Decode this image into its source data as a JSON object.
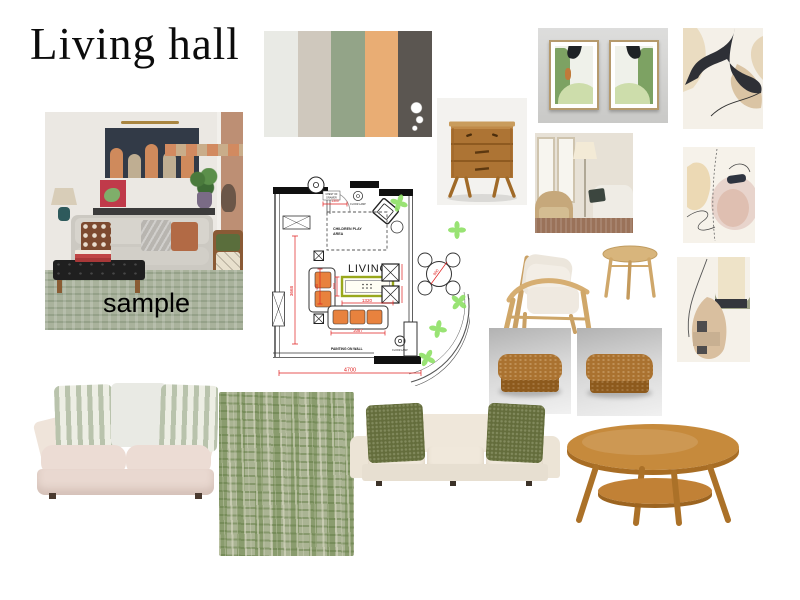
{
  "board": {
    "title": "Living hall",
    "sample_label": "sample"
  },
  "palette": {
    "colors": [
      "#e9eae5",
      "#cfc8bd",
      "#93a488",
      "#e9ad74",
      "#5b5651"
    ]
  },
  "floor_plan": {
    "labels": {
      "living": "LIVING",
      "play_line1": "CHILDREN PLAY",
      "play_line2": "AREA",
      "chest_line1": "CHEST OF",
      "chest_line2": "DRAWER",
      "floor_lamp": "FLOOR LAMP",
      "painting": "PAINTING ON WALL"
    },
    "dims": {
      "total_width": "4700",
      "table_width": "1320",
      "table_depth": "600",
      "room_height": "3668",
      "sofa_side": "450",
      "sofa_width": "2087",
      "dining_table": "900",
      "chest_width": "1300"
    },
    "accent_red": "#e02020",
    "plant_green": "#8fe065",
    "table_outline": "#99a81c"
  }
}
